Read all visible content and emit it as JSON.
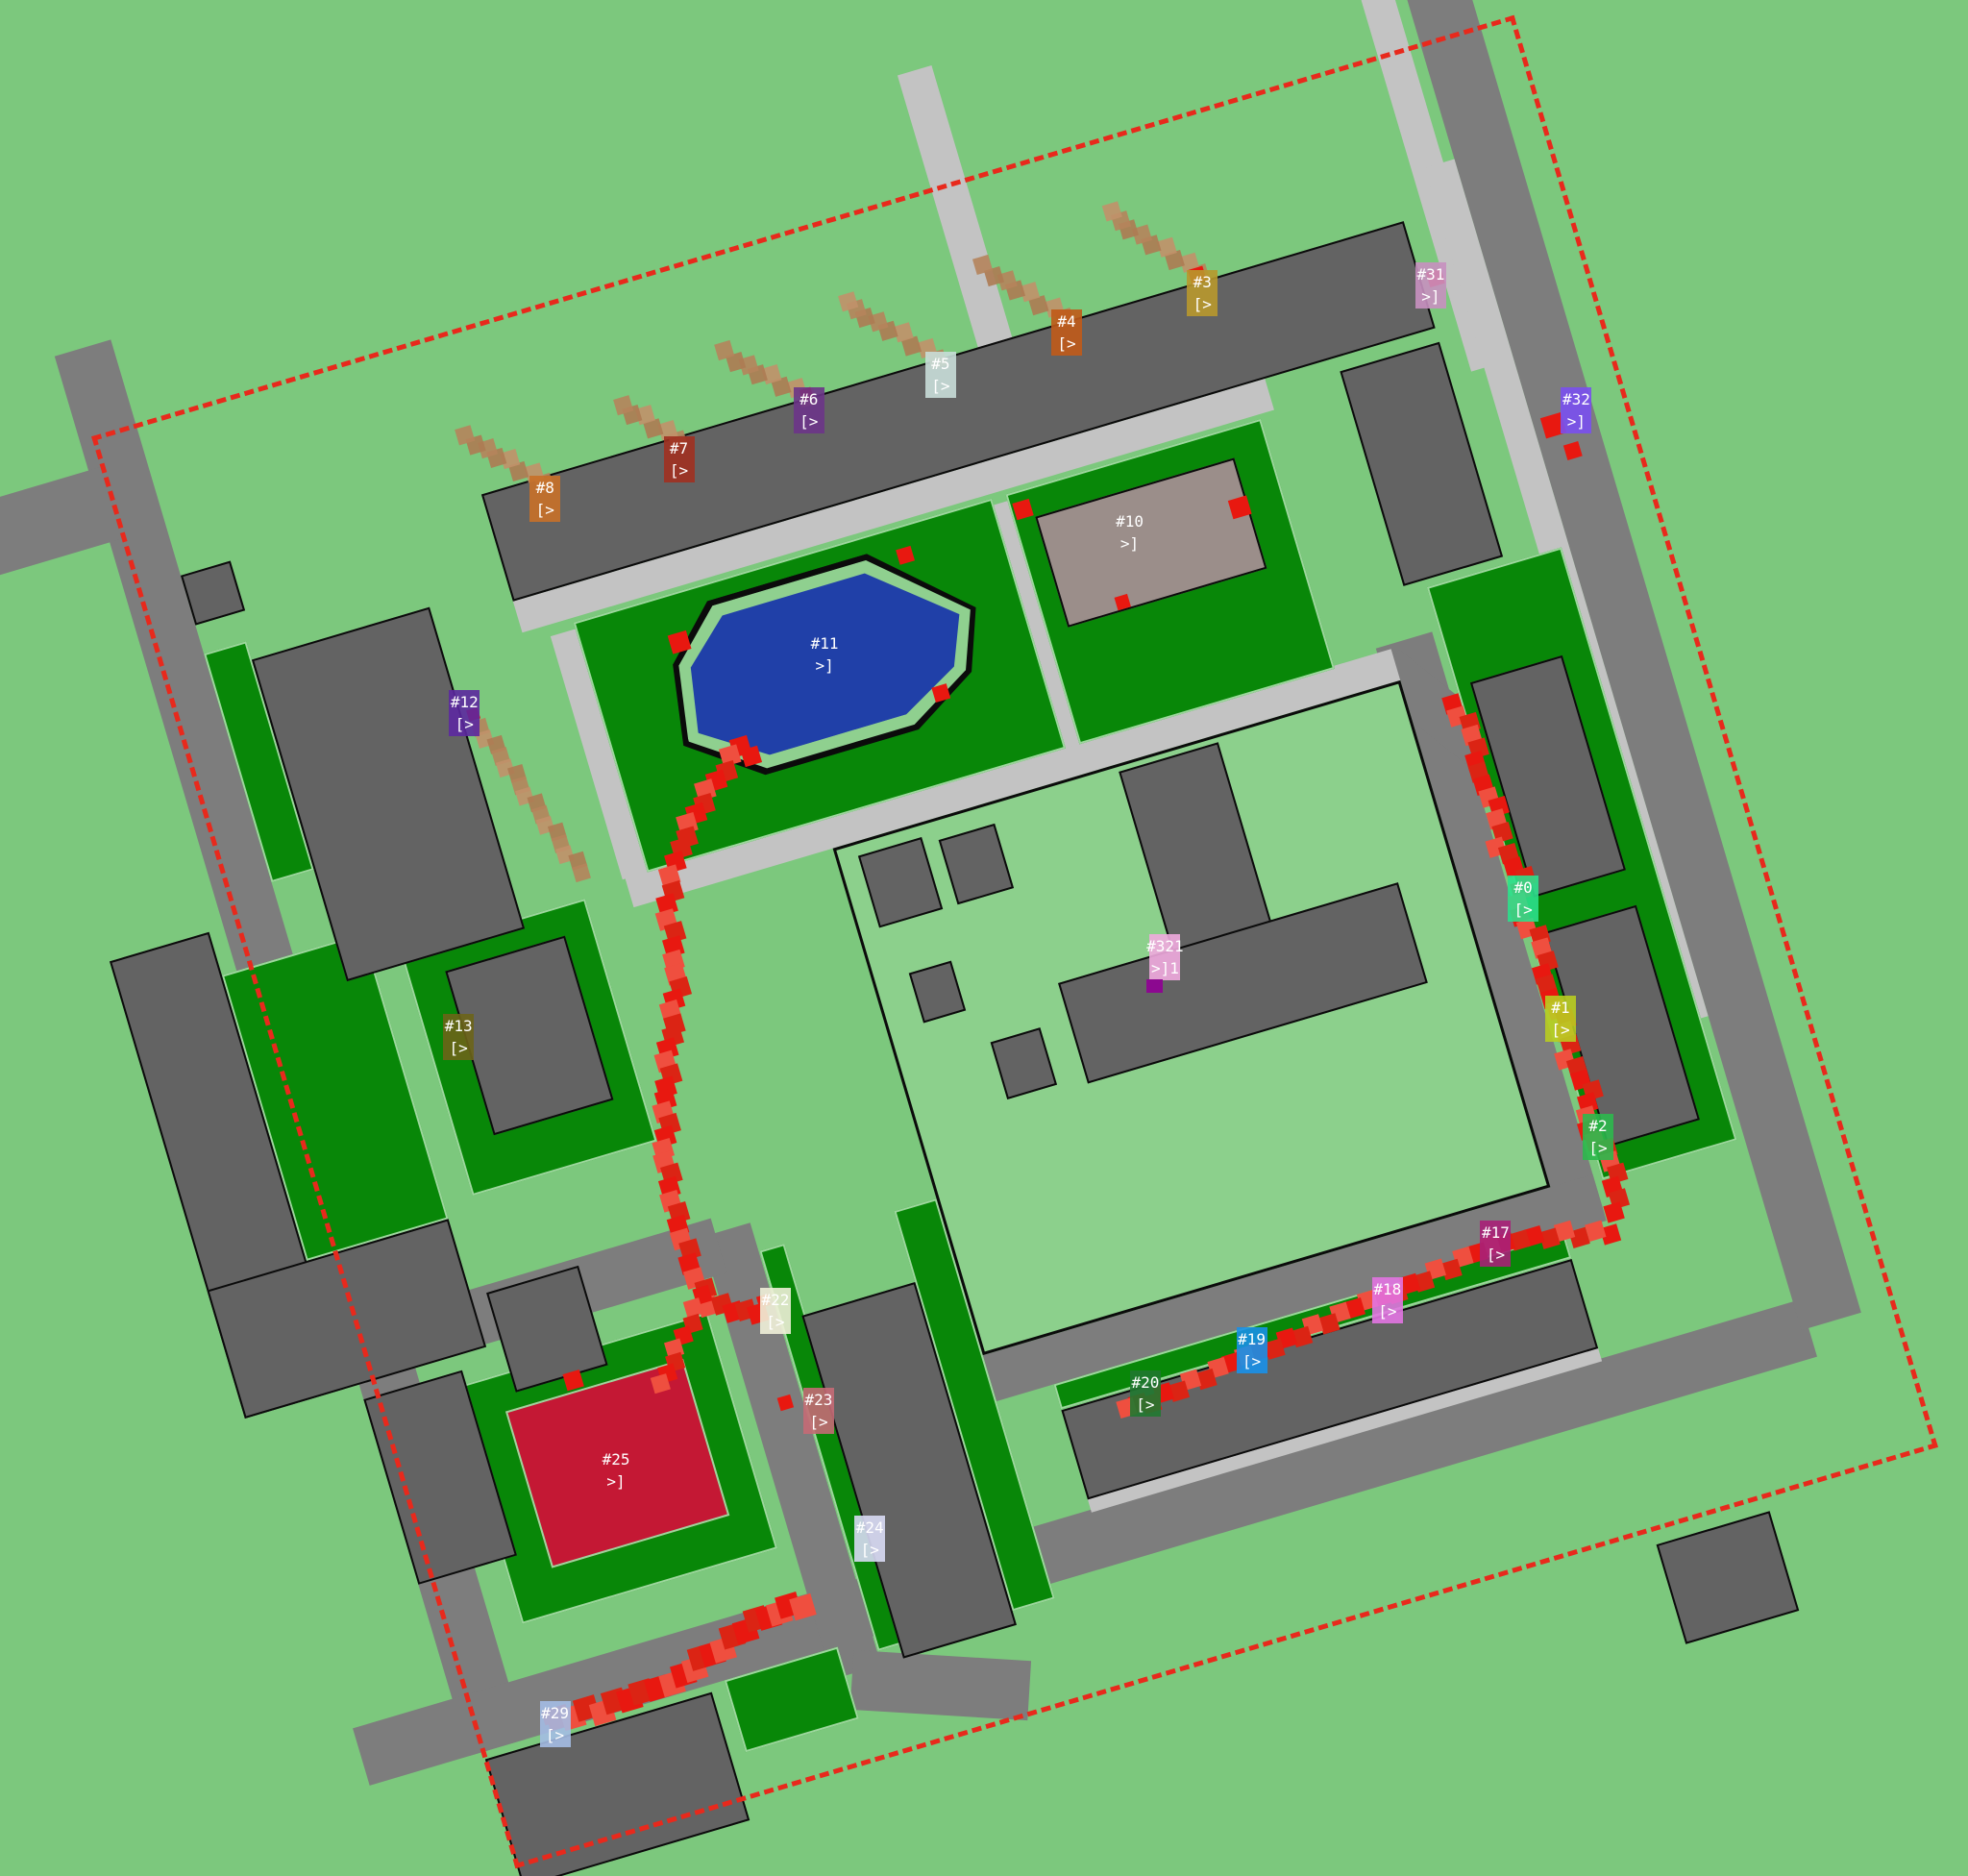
{
  "scene": {
    "title": "agent-simulation-map",
    "background_color": "#7cc87d",
    "boundary_color": "#e8291c",
    "road_color": "#7d7d7d",
    "path_color": "#c3c3c3",
    "building_color": "#636363",
    "lawn_color": "#088708",
    "courtyard_color": "#8cd08c",
    "pond_color": "#2040a8",
    "pond_ring_color": "#8fd08f",
    "mauve_building_color": "#9b8e8a",
    "red_building_color": "#c41834",
    "trail_colors": [
      "#e81810",
      "#ef4f3f",
      "#db2414"
    ],
    "trail_faded_colors": [
      "#b5845c",
      "#c1916a",
      "#ad7b53"
    ]
  },
  "markers": [
    {
      "id": "0",
      "label": "#0",
      "glyph": "[>",
      "color": "#2ce08c",
      "x": 77.4,
      "y": 47.9
    },
    {
      "id": "1",
      "label": "#1",
      "glyph": "[>",
      "color": "#b8cc20",
      "x": 79.3,
      "y": 54.3
    },
    {
      "id": "2",
      "label": "#2",
      "glyph": "[>",
      "color": "#2cb84c",
      "x": 81.2,
      "y": 60.6
    },
    {
      "id": "3",
      "label": "#3",
      "glyph": "[>",
      "color": "#b8982c",
      "x": 61.1,
      "y": 15.6
    },
    {
      "id": "4",
      "label": "#4",
      "glyph": "[>",
      "color": "#c05a18",
      "x": 54.2,
      "y": 17.7
    },
    {
      "id": "5",
      "label": "#5",
      "glyph": "[>",
      "color": "#c8ddd8",
      "x": 47.8,
      "y": 20.0
    },
    {
      "id": "6",
      "label": "#6",
      "glyph": "[>",
      "color": "#6c3488",
      "x": 41.1,
      "y": 21.9
    },
    {
      "id": "7",
      "label": "#7",
      "glyph": "[>",
      "color": "#a03020",
      "x": 34.5,
      "y": 24.5
    },
    {
      "id": "8",
      "label": "#8",
      "glyph": "[>",
      "color": "#c87028",
      "x": 27.7,
      "y": 26.6
    },
    {
      "id": "10",
      "label": "#10",
      "glyph": ">]",
      "color": "",
      "x": 57.4,
      "y": 28.4
    },
    {
      "id": "11",
      "label": "#11",
      "glyph": ">]",
      "color": "",
      "x": 41.9,
      "y": 34.9
    },
    {
      "id": "12",
      "label": "#12",
      "glyph": "[>",
      "color": "#5c28a0",
      "x": 23.6,
      "y": 38.0
    },
    {
      "id": "13",
      "label": "#13",
      "glyph": "[>",
      "color": "#6c6418",
      "x": 23.3,
      "y": 55.3
    },
    {
      "id": "17",
      "label": "#17",
      "glyph": "[>",
      "color": "#a82078",
      "x": 76.0,
      "y": 66.3
    },
    {
      "id": "18",
      "label": "#18",
      "glyph": "[>",
      "color": "#e274e2",
      "x": 70.5,
      "y": 69.3
    },
    {
      "id": "19",
      "label": "#19",
      "glyph": "[>",
      "color": "#1890e8",
      "x": 63.6,
      "y": 72.0
    },
    {
      "id": "20",
      "label": "#20",
      "glyph": "[>",
      "color": "#207830",
      "x": 58.2,
      "y": 74.3
    },
    {
      "id": "21",
      "label": "#321",
      "glyph": ">]1",
      "color": "#f0aade",
      "x": 59.2,
      "y": 51.0,
      "accent": "#8c0890"
    },
    {
      "id": "22",
      "label": "#22",
      "glyph": "[>",
      "color": "#f0f0d8",
      "x": 39.4,
      "y": 69.9
    },
    {
      "id": "23",
      "label": "#23",
      "glyph": "[>",
      "color": "#c56a76",
      "x": 41.6,
      "y": 75.2
    },
    {
      "id": "24",
      "label": "#24",
      "glyph": "[>",
      "color": "#d8daf4",
      "x": 44.2,
      "y": 82.0
    },
    {
      "id": "25",
      "label": "#25",
      "glyph": ">]",
      "color": "",
      "x": 31.3,
      "y": 78.4
    },
    {
      "id": "29",
      "label": "#29",
      "glyph": "[>",
      "color": "#a4bce4",
      "x": 28.2,
      "y": 91.9
    },
    {
      "id": "31",
      "label": "#31",
      "glyph": ">]",
      "color": "#c890c0",
      "x": 72.7,
      "y": 15.2
    },
    {
      "id": "32",
      "label": "#32",
      "glyph": ">]",
      "color": "#7a50f0",
      "x": 80.1,
      "y": 21.9
    }
  ],
  "trails": {
    "red": [
      {
        "w": 19,
        "points": [
          [
            36,
            32.2
          ],
          [
            33,
            34.5
          ],
          [
            30,
            37.5
          ],
          [
            28.2,
            41
          ],
          [
            27.6,
            45.7
          ],
          [
            25.8,
            49.5
          ],
          [
            24.4,
            53.5
          ],
          [
            23.2,
            57.5
          ],
          [
            22.8,
            61
          ],
          [
            22.8,
            64.5
          ],
          [
            23.2,
            67.5
          ],
          [
            25.5,
            68.8
          ],
          [
            27,
            69
          ]
        ]
      },
      {
        "w": 17,
        "points": [
          [
            23,
            66.8
          ],
          [
            20.3,
            69.8
          ],
          [
            18.2,
            72.5
          ]
        ]
      },
      {
        "w": 18,
        "points": [
          [
            82.9,
            43
          ],
          [
            83.8,
            45.5
          ],
          [
            83.1,
            48
          ],
          [
            84,
            50.5
          ],
          [
            83.2,
            53
          ],
          [
            84.1,
            55.5
          ],
          [
            83.3,
            58
          ],
          [
            84.2,
            60.5
          ],
          [
            83.4,
            63
          ],
          [
            84.3,
            65.5
          ],
          [
            83.5,
            68
          ],
          [
            84.4,
            70.5
          ],
          [
            83.6,
            73
          ],
          [
            84.5,
            75.5
          ],
          [
            84,
            78
          ],
          [
            83.5,
            79.8
          ]
        ]
      },
      {
        "w": 18,
        "points": [
          [
            83,
            80.2
          ],
          [
            80,
            79.3
          ],
          [
            77,
            78.6
          ],
          [
            74,
            78.9
          ],
          [
            71,
            79.3
          ],
          [
            68,
            79.7
          ],
          [
            65,
            80.1
          ],
          [
            62,
            80.5
          ],
          [
            59,
            80.9
          ],
          [
            56,
            81.3
          ],
          [
            53,
            81.7
          ],
          [
            50,
            82.1
          ],
          [
            47.5,
            82.4
          ]
        ]
      },
      {
        "w": 23,
        "points": [
          [
            5.5,
            91.2
          ],
          [
            8.5,
            91.5
          ],
          [
            11.5,
            91.4
          ],
          [
            14.5,
            90.8
          ],
          [
            17.5,
            89.8
          ],
          [
            20.3,
            88.9
          ],
          [
            22.6,
            88.3
          ],
          [
            24.5,
            88.9
          ]
        ]
      }
    ],
    "faded": [
      {
        "w": 17,
        "points": [
          [
            74.8,
            10.5
          ],
          [
            73,
            8.3
          ],
          [
            71.2,
            6.2
          ],
          [
            69.7,
            4.4
          ]
        ]
      },
      {
        "w": 17,
        "points": [
          [
            65.2,
            10.8
          ],
          [
            63.3,
            8.6
          ],
          [
            61.6,
            6.6
          ],
          [
            60.2,
            5
          ]
        ]
      },
      {
        "w": 17,
        "points": [
          [
            56.2,
            11
          ],
          [
            54.3,
            8.8
          ],
          [
            52.4,
            6.8
          ],
          [
            50.8,
            5.2
          ]
        ]
      },
      {
        "w": 17,
        "points": [
          [
            47,
            11
          ],
          [
            45,
            9
          ],
          [
            43.2,
            7.2
          ],
          [
            41.8,
            5.6
          ]
        ]
      },
      {
        "w": 17,
        "points": [
          [
            37.8,
            11.3
          ],
          [
            36,
            9.2
          ],
          [
            34.4,
            7.4
          ]
        ]
      },
      {
        "w": 17,
        "points": [
          [
            28.3,
            11.5
          ],
          [
            26.4,
            9.4
          ],
          [
            24.8,
            7.6
          ],
          [
            23.4,
            6.2
          ]
        ]
      },
      {
        "w": 16,
        "points": [
          [
            19.5,
            26
          ],
          [
            20.5,
            29
          ],
          [
            21.5,
            32
          ],
          [
            22.5,
            35
          ],
          [
            23.5,
            38
          ]
        ]
      }
    ],
    "accents": [
      [
        34,
        24.3,
        20
      ],
      [
        50.3,
        23,
        16
      ],
      [
        36.5,
        33,
        18
      ],
      [
        50,
        32.6,
        16
      ],
      [
        58.8,
        22.3,
        18
      ],
      [
        72.9,
        26.3,
        20
      ],
      [
        63.5,
        30.2,
        14
      ],
      [
        90,
        15.3,
        16
      ],
      [
        94.8,
        27,
        22
      ],
      [
        95.6,
        29,
        16
      ],
      [
        74.6,
        10.6,
        16
      ],
      [
        47,
        10.8,
        12
      ],
      [
        19.3,
        25,
        12
      ],
      [
        26.8,
        68.3,
        12
      ],
      [
        26.3,
        75.3,
        14
      ],
      [
        13,
        69.8,
        18
      ],
      [
        5,
        91,
        14
      ]
    ]
  }
}
